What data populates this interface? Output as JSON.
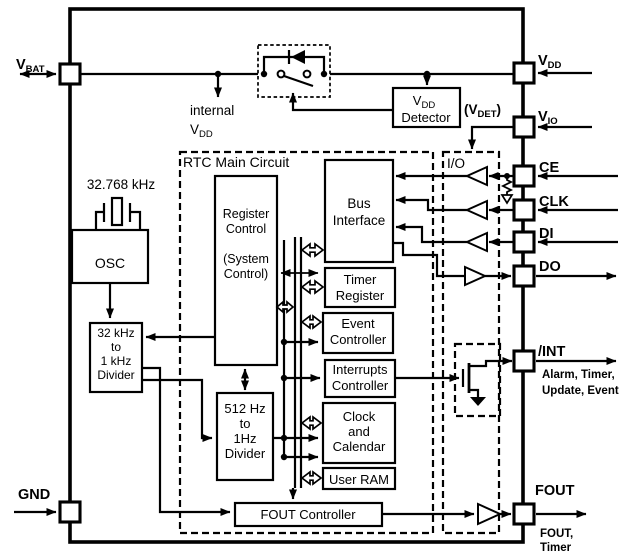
{
  "colors": {
    "ink": "#000000",
    "bg": "#ffffff"
  },
  "pins": {
    "vbat": {
      "main": "V",
      "sub": "BAT"
    },
    "vdd": {
      "main": "V",
      "sub": "DD"
    },
    "vio": {
      "main": "V",
      "sub": "IO"
    },
    "ce": "CE",
    "clk": "CLK",
    "di": "DI",
    "do": "DO",
    "int": "/INT",
    "fout": "FOUT",
    "gnd": "GND"
  },
  "notes": {
    "internal_vdd": {
      "word": "internal",
      "main": "V",
      "sub": "DD"
    },
    "vdet": {
      "pre": "(V",
      "sub": "DET",
      "post": ")"
    },
    "osc_freq": "32.768 kHz",
    "rtc_region": "RTC Main Circuit",
    "io_region": "I/O",
    "int_events_1": "Alarm, Timer,",
    "int_events_2": "Update, Event",
    "fout_events_1": "FOUT,",
    "fout_events_2": "Timer"
  },
  "blocks": {
    "vdd_detector": {
      "main": "V",
      "sub": "DD",
      "line2": "Detector"
    },
    "osc": "OSC",
    "divider_32k": {
      "l1": "32 kHz",
      "l2": "to",
      "l3": "1 kHz",
      "l4": "Divider"
    },
    "divider_512": {
      "l1": "512 Hz",
      "l2": "to",
      "l3": "1Hz",
      "l4": "Divider"
    },
    "register_control": {
      "l1": "Register",
      "l2": "Control",
      "l3": "(System",
      "l4": "Control)"
    },
    "bus_interface": {
      "l1": "Bus",
      "l2": "Interface"
    },
    "timer_register": {
      "l1": "Timer",
      "l2": "Register"
    },
    "event_controller": {
      "l1": "Event",
      "l2": "Controller"
    },
    "interrupts_controller": {
      "l1": "Interrupts",
      "l2": "Controller"
    },
    "clock_calendar": {
      "l1": "Clock",
      "l2": "and",
      "l3": "Calendar"
    },
    "user_ram": "User RAM",
    "fout_controller": "FOUT Controller"
  }
}
